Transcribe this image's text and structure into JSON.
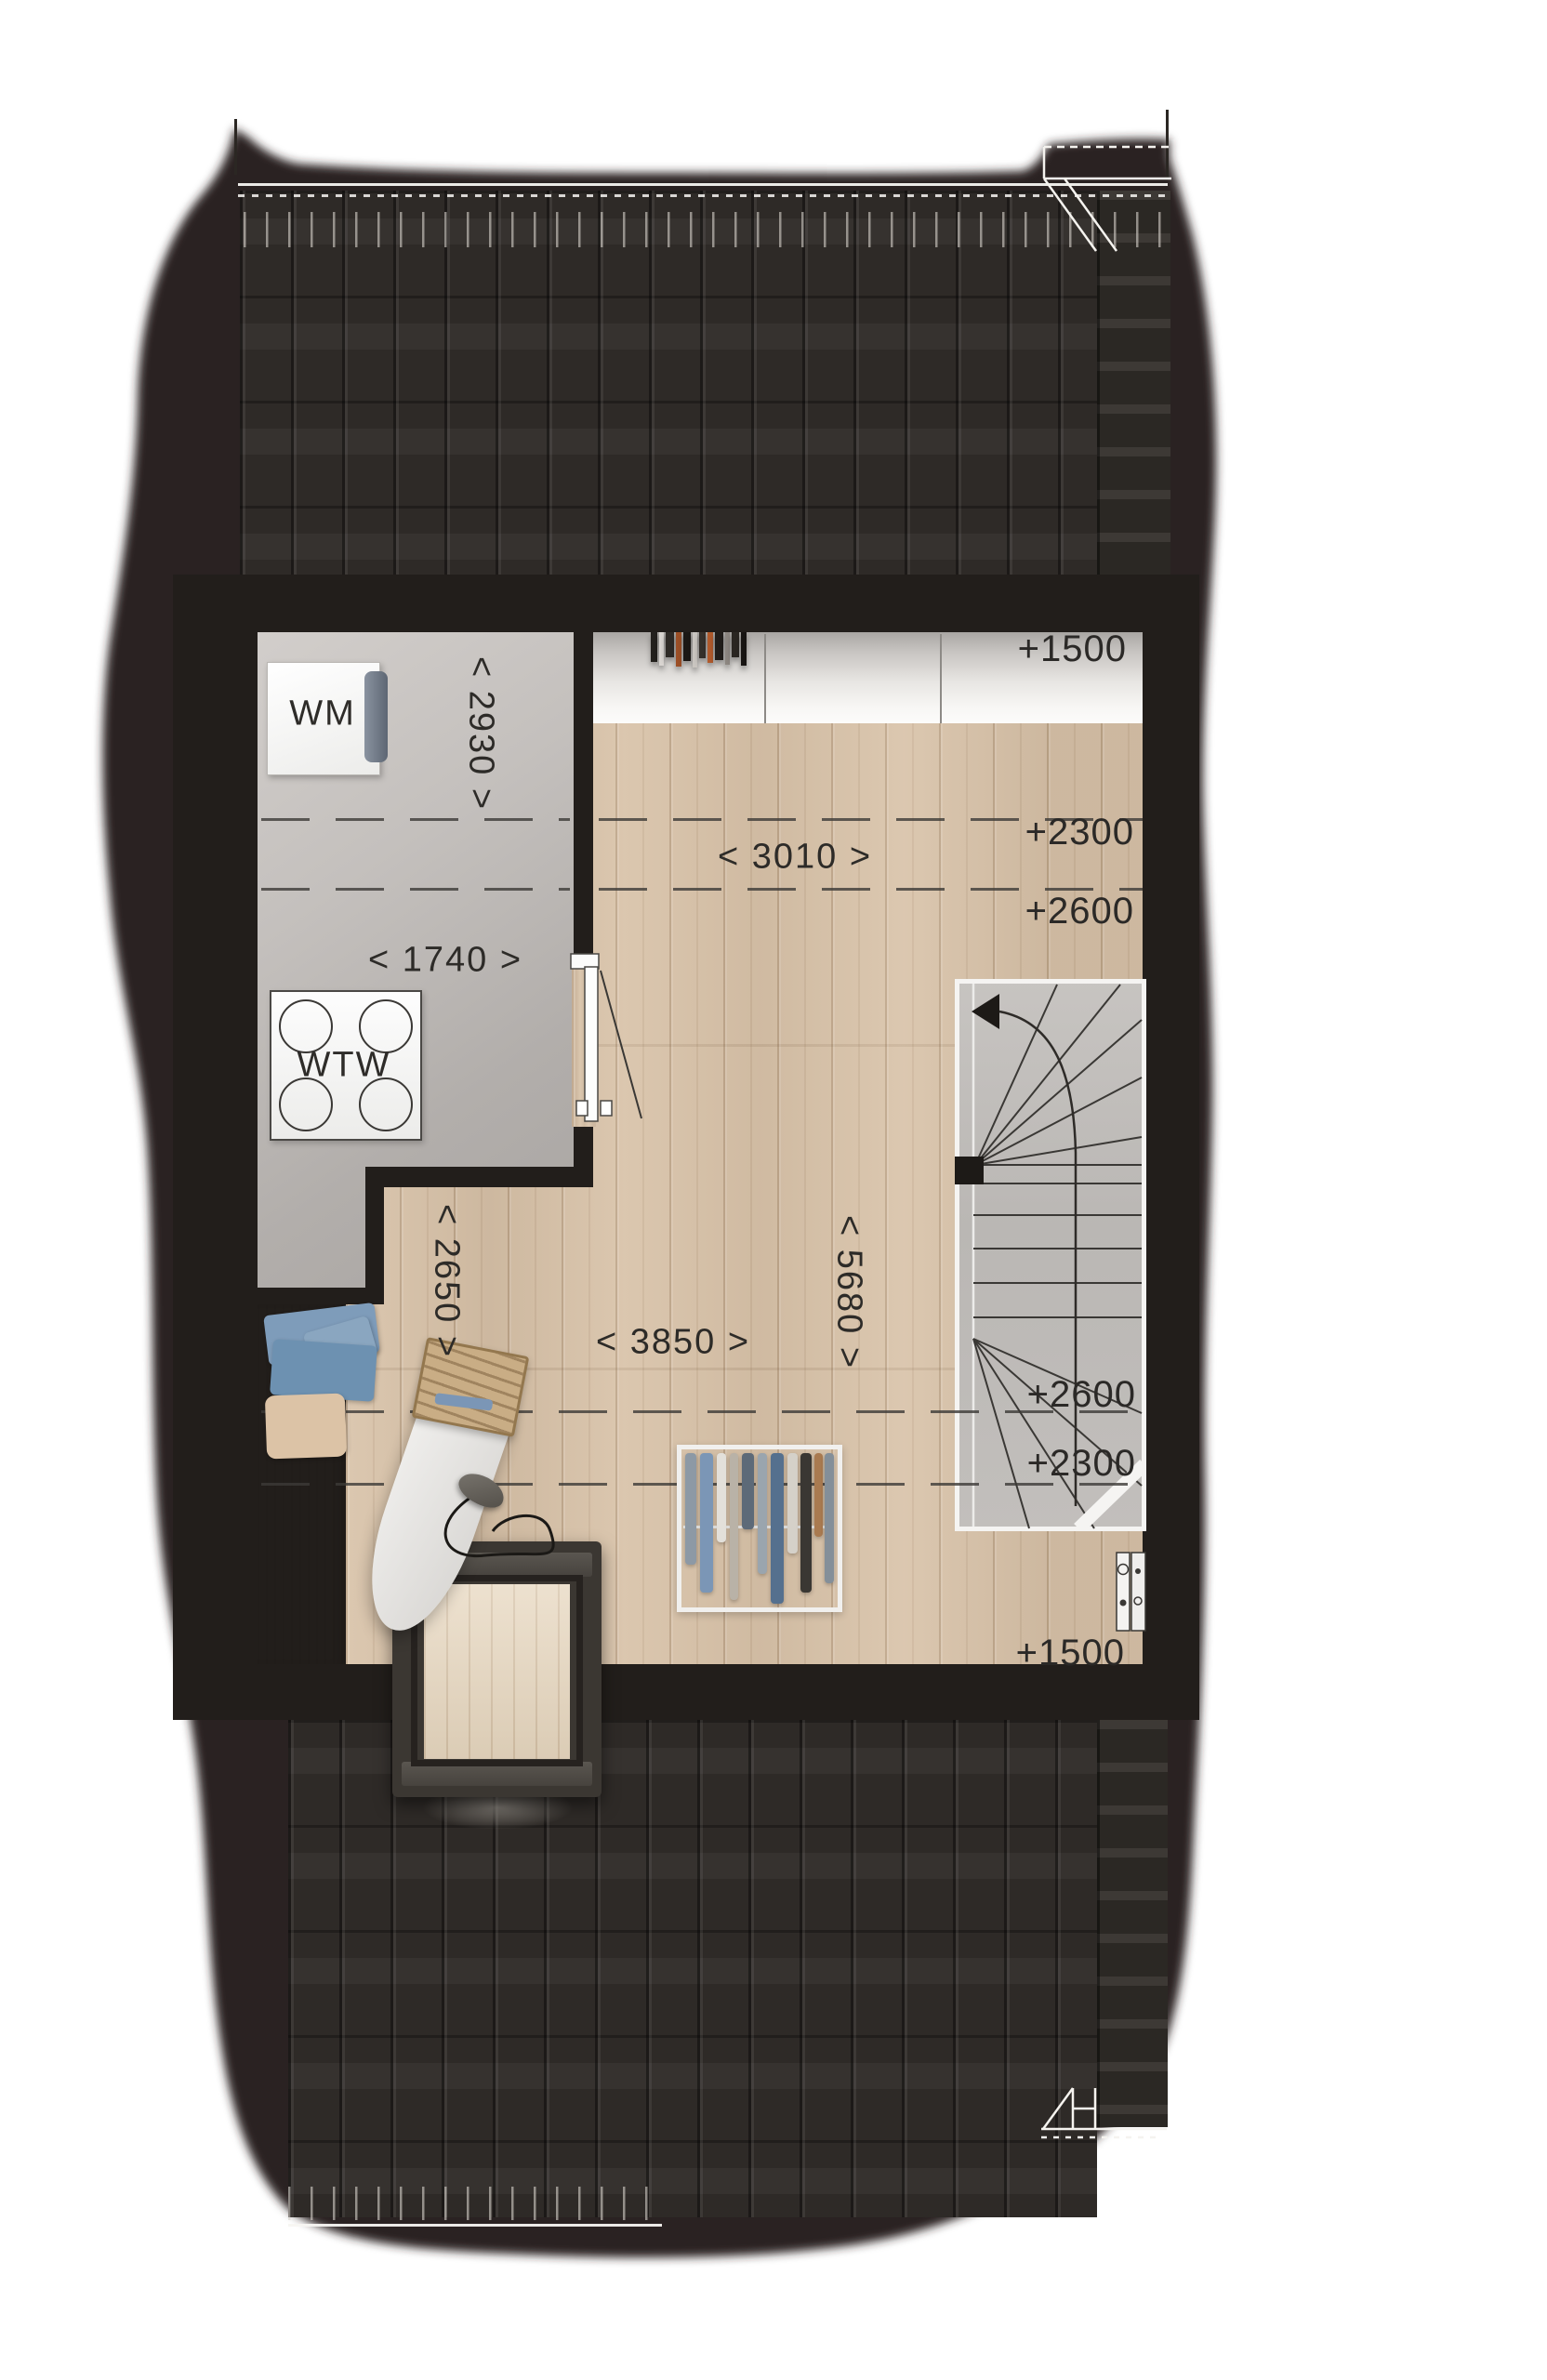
{
  "floorplan": {
    "appliances": {
      "washing_machine": "WM",
      "heat_recovery_unit": "WTW"
    },
    "dimensions": {
      "laundry_depth": "< 2930 >",
      "laundry_width": "< 1740 >",
      "room_width_top": "< 3010 >",
      "room_depth_left": "< 2650 >",
      "room_width_bottom": "< 3850 >",
      "room_depth_right": "< 5680 >"
    },
    "height_markers": {
      "top_right": "+1500",
      "upper_right_a": "+2300",
      "upper_right_b": "+2600",
      "lower_right_a": "+2600",
      "lower_right_b": "+2300",
      "bottom_right": "+1500"
    },
    "colors": {
      "roof_dark": "#2b2521",
      "wall_dark": "#221e1b",
      "wood_floor": "#d8c2a8",
      "screed_floor": "#bcb8b5",
      "label_text": "#2d2b28",
      "accent_white": "#f7f5f2"
    }
  }
}
